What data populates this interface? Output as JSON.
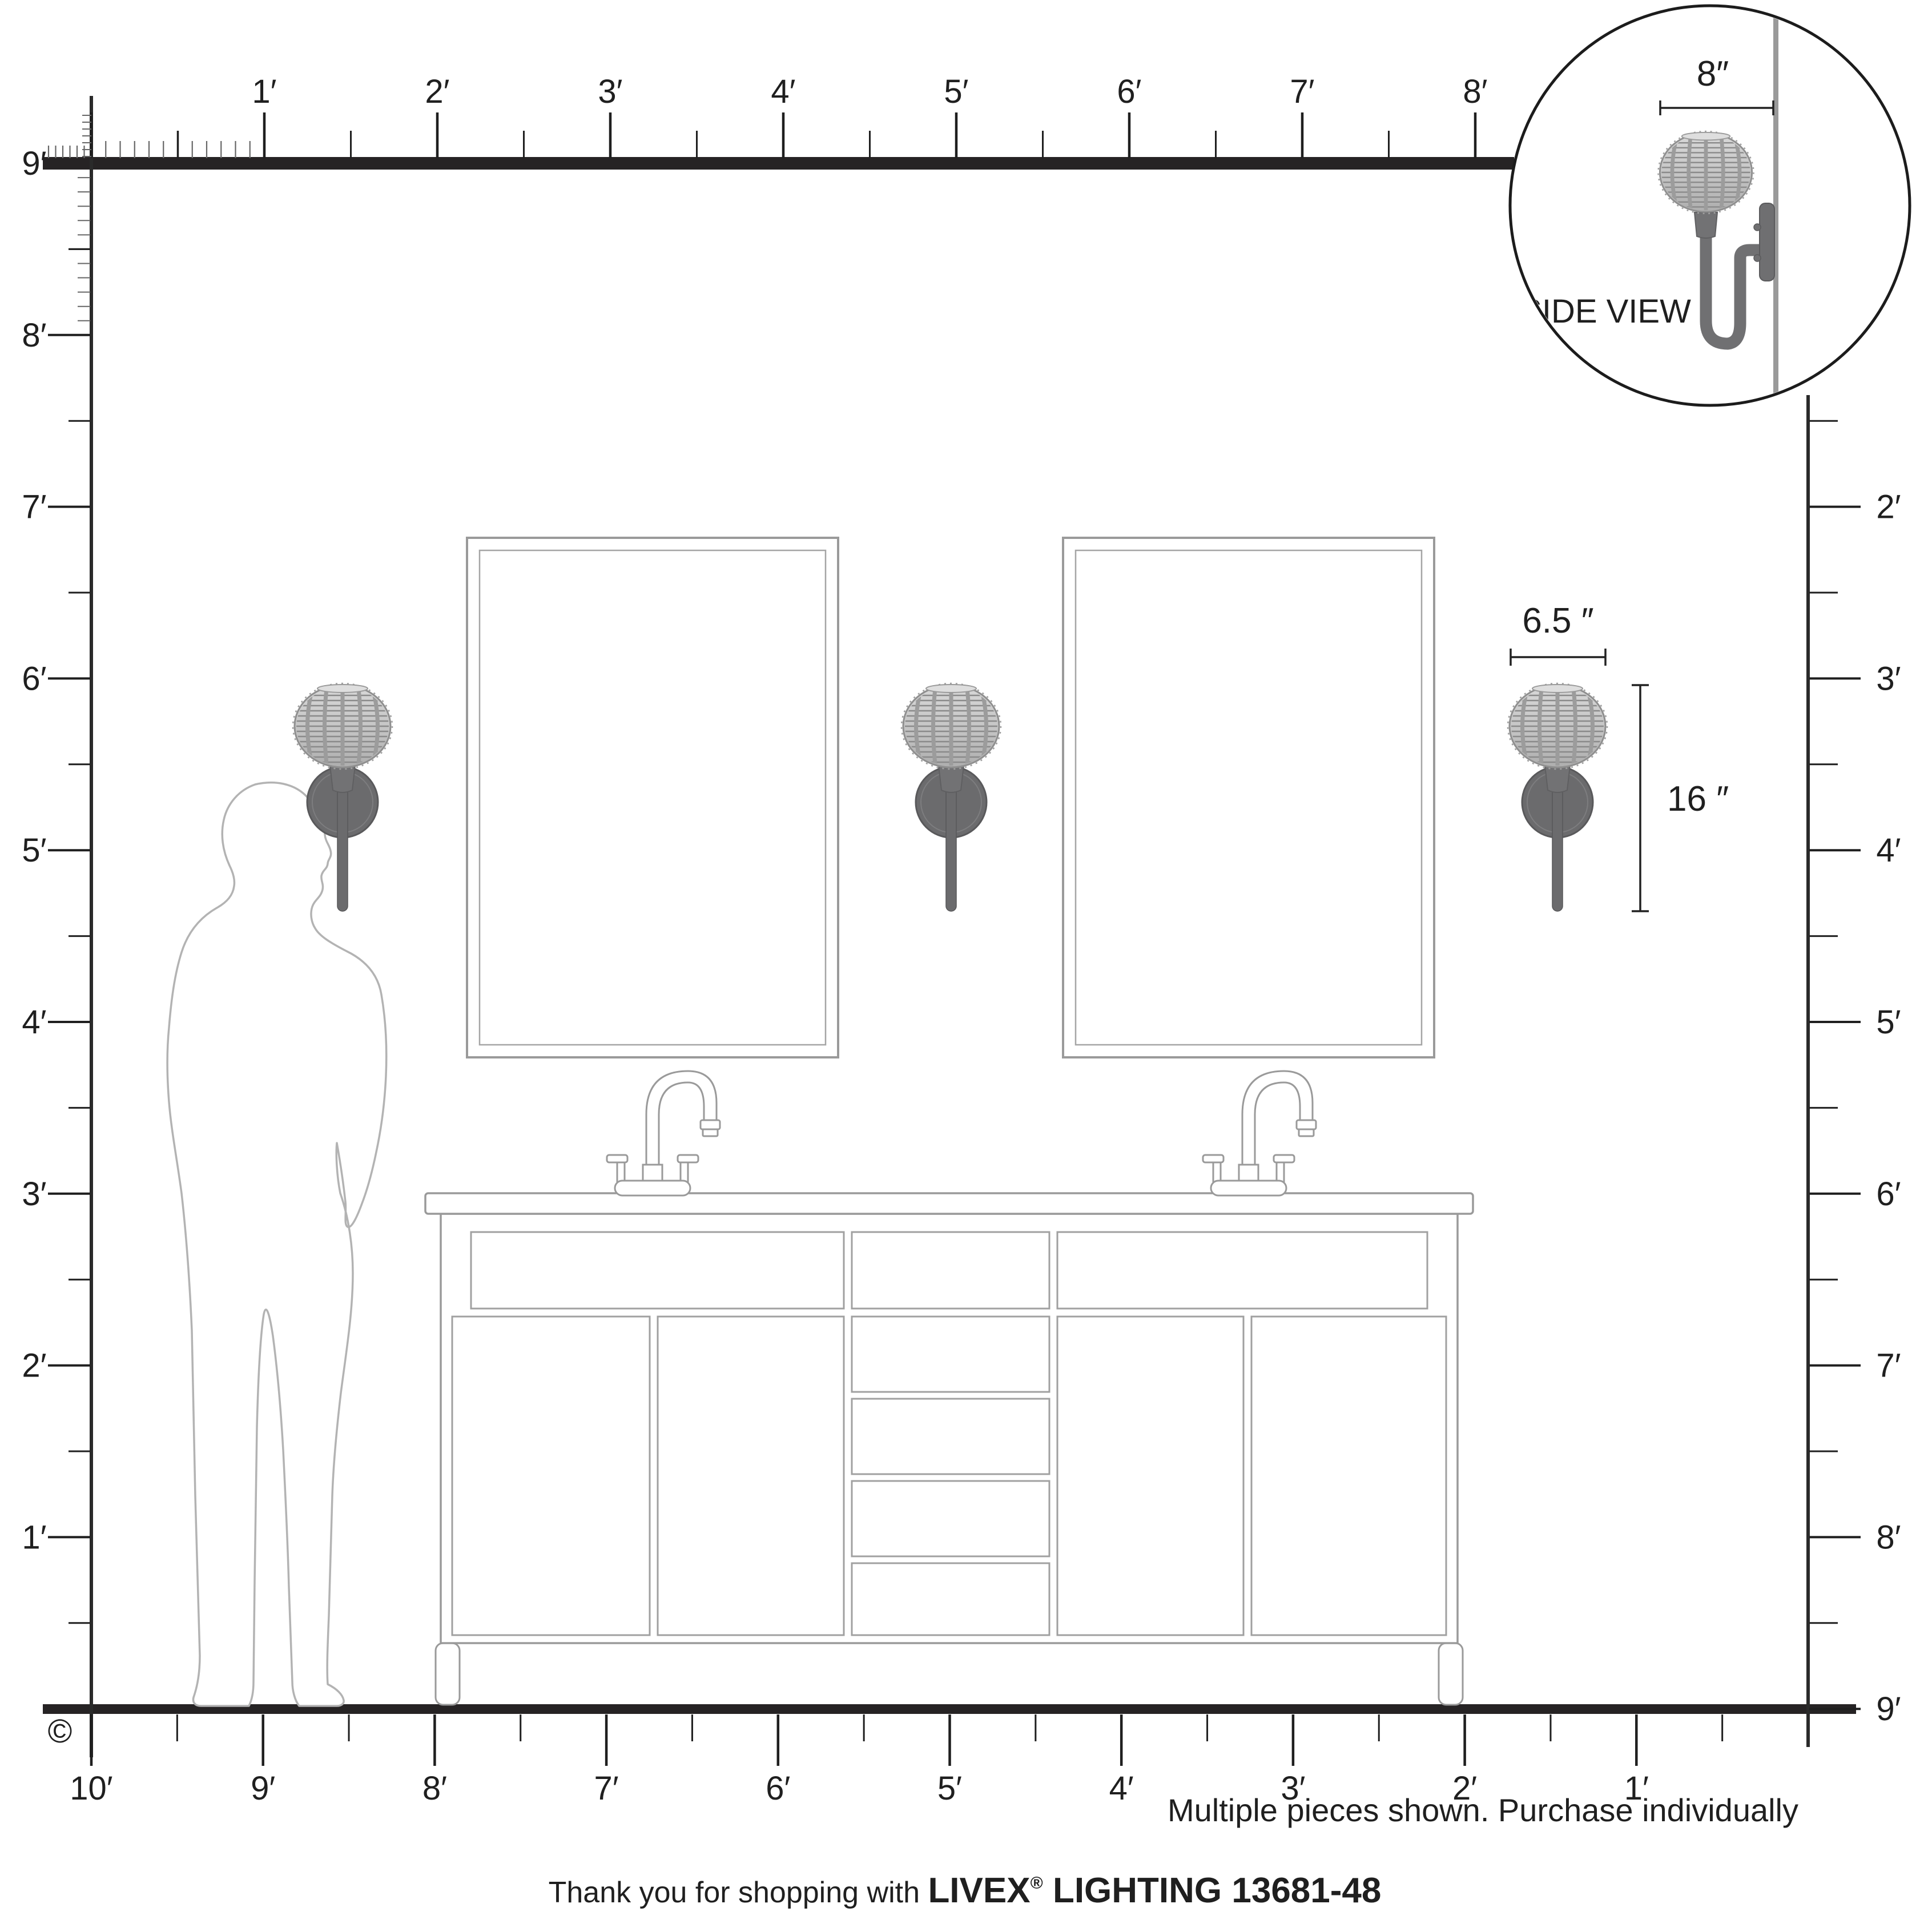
{
  "inset": {
    "side_view_label": "SIDE VIEW",
    "depth_dim": "8″"
  },
  "sconce_dims": {
    "width": "6.5 ″",
    "height": "16 ″"
  },
  "rulers": {
    "top": [
      "1′",
      "2′",
      "3′",
      "4′",
      "5′",
      "6′",
      "7′",
      "8′"
    ],
    "left": [
      "9′",
      "8′",
      "7′",
      "6′",
      "5′",
      "4′",
      "3′",
      "2′",
      "1′"
    ],
    "right": [
      "2′",
      "3′",
      "4′",
      "5′",
      "6′",
      "7′",
      "8′",
      "9′"
    ],
    "bottom": [
      "10′",
      "9′",
      "8′",
      "7′",
      "6′",
      "5′",
      "4′",
      "3′",
      "2′",
      "1′"
    ]
  },
  "footer": {
    "copyright": "©",
    "note": "Multiple pieces shown. Purchase individually",
    "thanks": "Thank you for shopping with ",
    "brand": "LIVEX",
    "registered": "®",
    "product": " LIGHTING 13681-48"
  },
  "colors": {
    "ink": "#1f1f1f",
    "wall_line": "#262324",
    "furniture_gray": "#9a9a9a",
    "person_gray": "#b3b3b3",
    "sconce_metal": "#6b6b6d",
    "shade_gray": "#c6c6c6"
  }
}
